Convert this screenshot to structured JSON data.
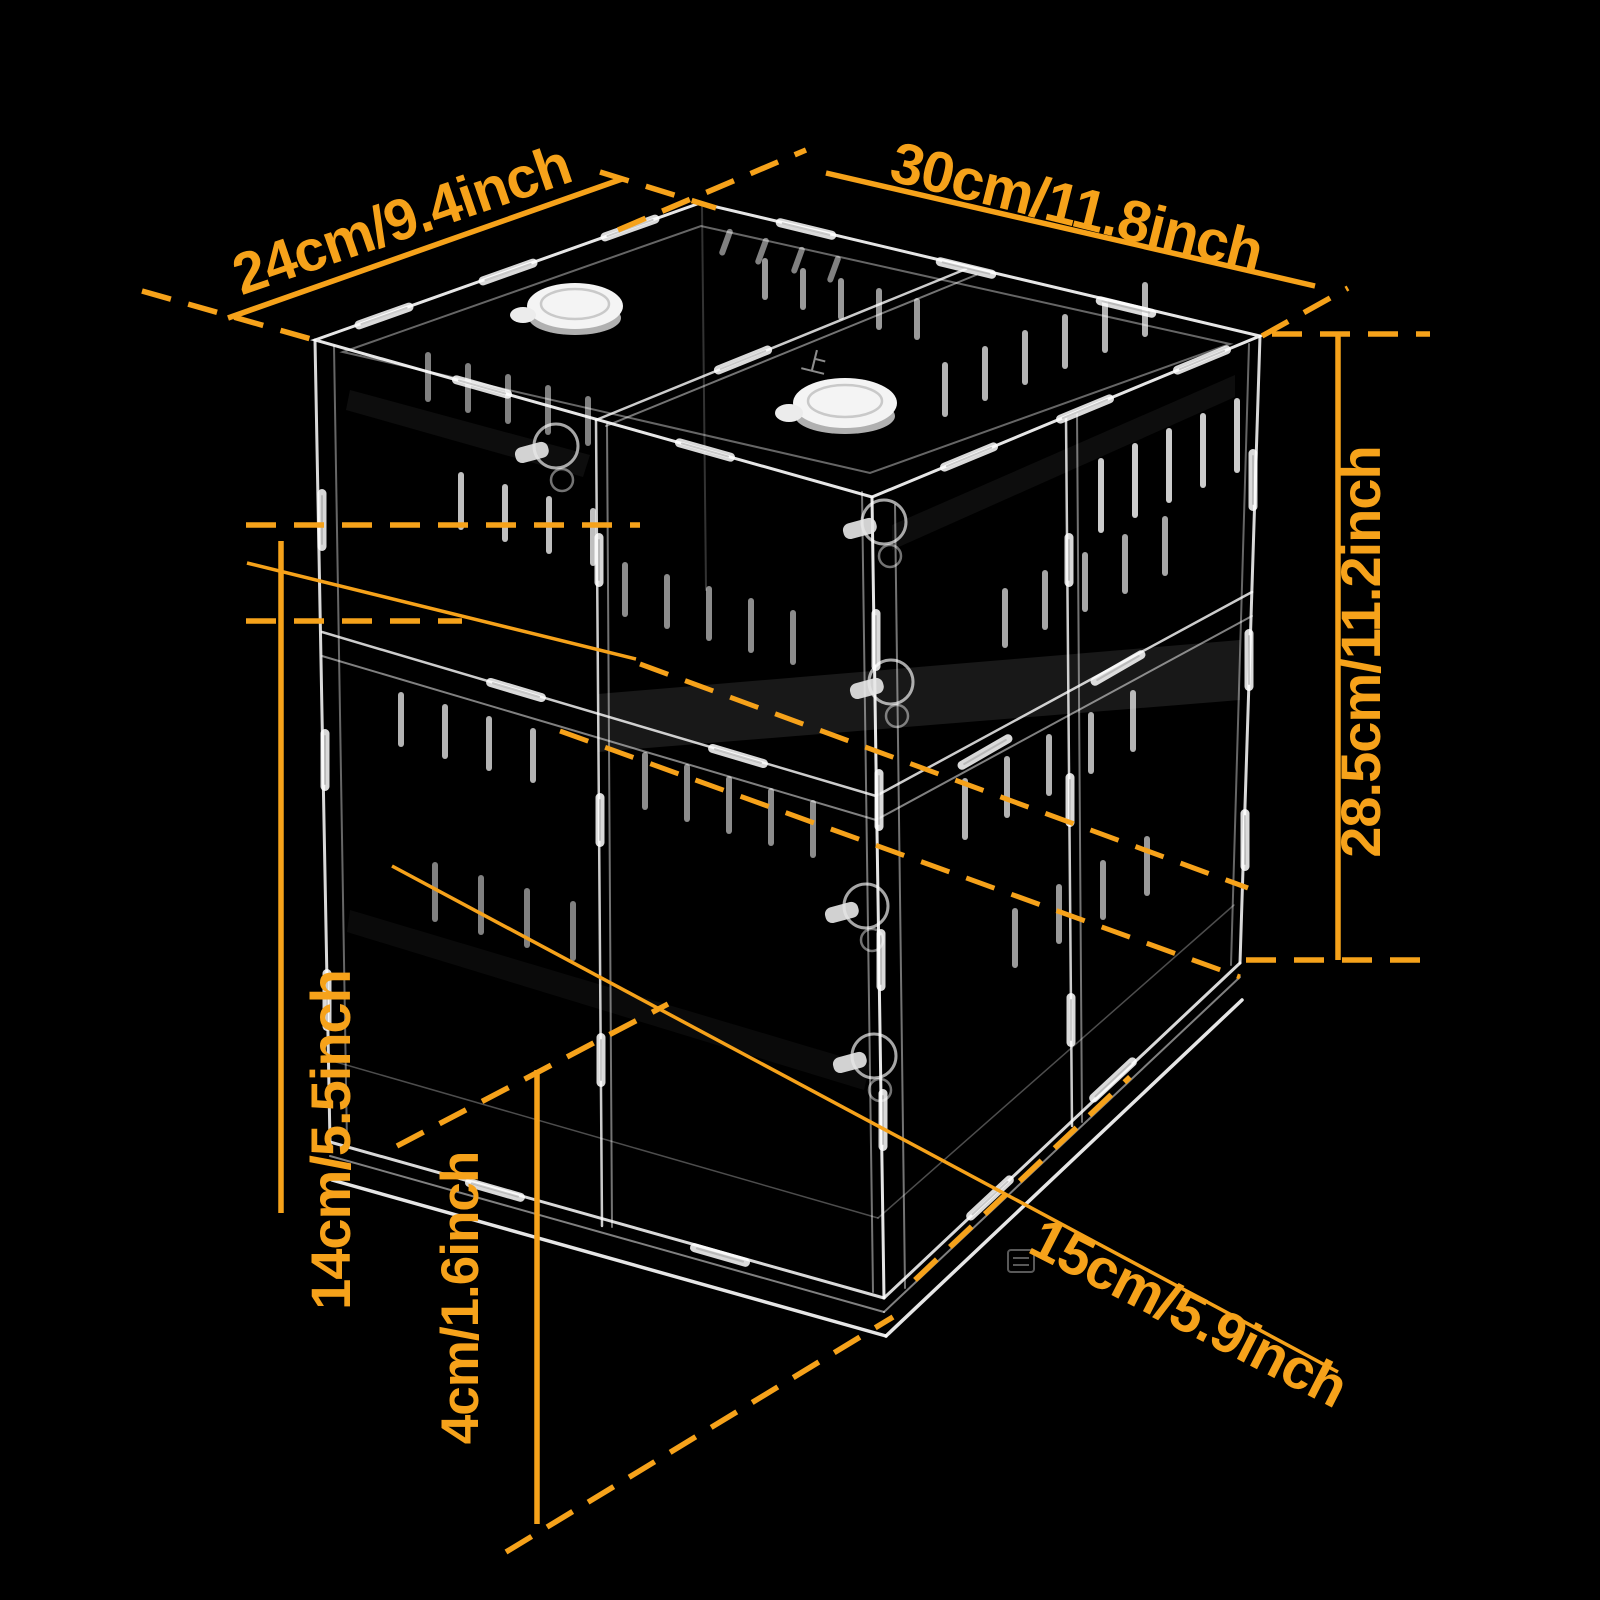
{
  "colors": {
    "background": "#000000",
    "accent": "#F6A21A"
  },
  "dimensions": {
    "depth": {
      "label": "24cm/9.4inch"
    },
    "width": {
      "label": "30cm/11.8inch"
    },
    "height": {
      "label": "28.5cm/11.2inch"
    },
    "lower_compartment_height": {
      "label": "14cm/5.5inch"
    },
    "base_height": {
      "label": "4cm/1.6inch"
    },
    "compartment_width": {
      "label": "15cm/5.9inch"
    }
  },
  "markings": {
    "top_face_marking": "上"
  }
}
